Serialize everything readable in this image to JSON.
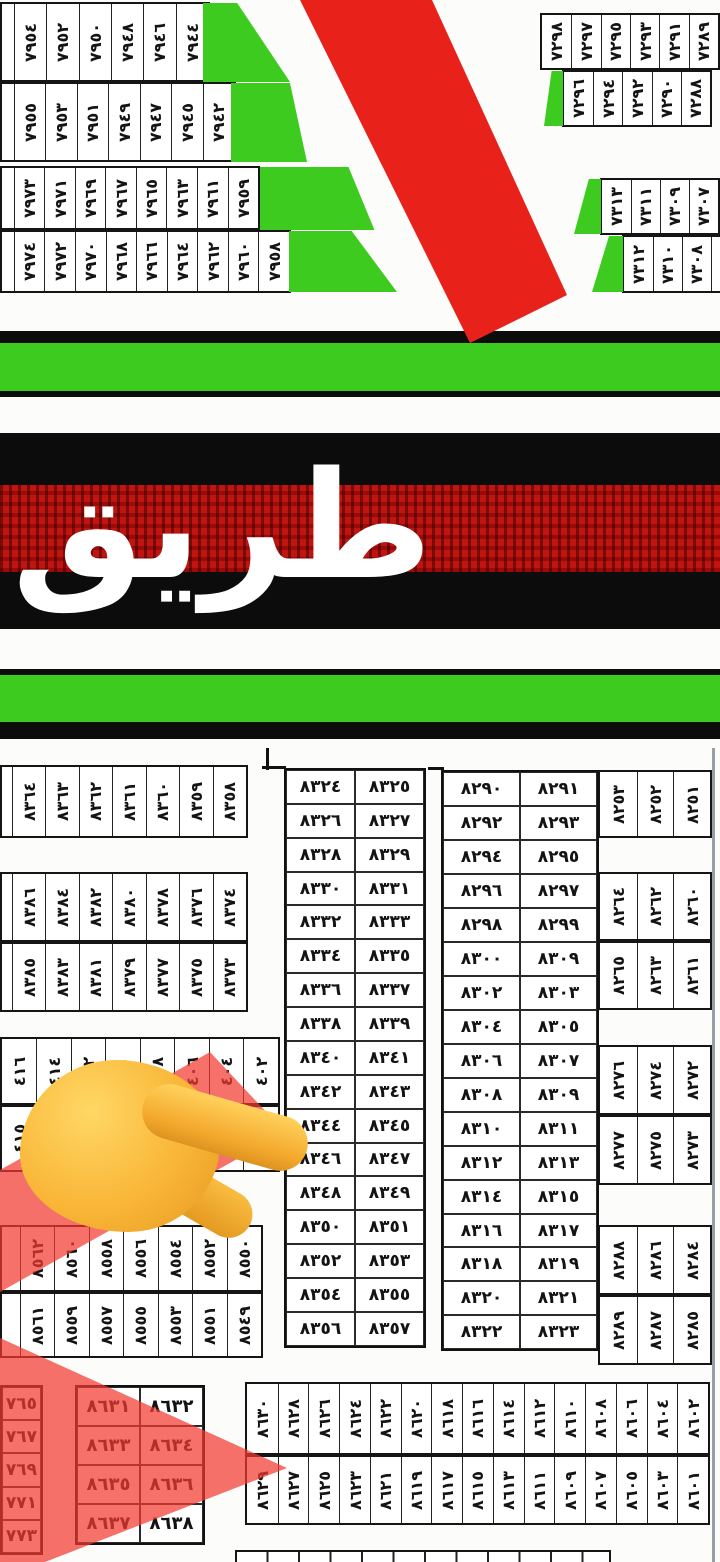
{
  "map": {
    "road_label": "طريق",
    "colors": {
      "block_green": "#3ecb20",
      "road_red_stripe": "#e8211b",
      "red_overlay": "#f33a30",
      "band_black": "#0c0c0c",
      "road_texture_red": "#c01410",
      "hand_yellow": "#f7b32b"
    },
    "top_left_block": {
      "row1": [
        "٧٩٥٤",
        "٧٩٥٢",
        "٧٩٥٠",
        "٧٩٤٨",
        "٧٩٤٦",
        "٧٩٤٤"
      ],
      "row2": [
        "٧٩٥٥",
        "٧٩٥٣",
        "٧٩٥١",
        "٧٩٤٩",
        "٧٩٤٧",
        "٧٩٤٥",
        "٧٩٤٢"
      ],
      "row3": [
        "٧٩٧٣",
        "٧٩٧١",
        "٧٩٦٩",
        "٧٩٦٧",
        "٧٩٦٥",
        "٧٩٦٣",
        "٧٩٦١",
        "٧٩٥٩"
      ],
      "row4": [
        "٧٩٧٤",
        "٧٩٧٢",
        "٧٩٧٠",
        "٧٩٦٨",
        "٧٩٦٦",
        "٧٩٦٤",
        "٧٩٦٢",
        "٧٩٦٠",
        "٧٩٥٨"
      ]
    },
    "top_right_blocks": {
      "b7290_row1": [
        "٧٢٩٨",
        "٧٢٩٧",
        "٧٢٩٥",
        "٧٢٩٣",
        "٧٢٩١",
        "٧٢٨٩"
      ],
      "b7290_row2": [
        "٧٢٩٦",
        "٧٢٩٤",
        "٧٢٩٢",
        "٧٢٩٠",
        "٧٢٨٨"
      ],
      "b7310_row1": [
        "٧٣١٣",
        "٧٣١١",
        "٧٣٠٩",
        "٧٣٠٧"
      ],
      "b7310_row2": [
        "٧٣١٢",
        "٧٣١٠",
        "٧٣٠٨",
        ""
      ]
    },
    "mid_left_strips": {
      "s8360": [
        "٨٣٦٤",
        "٨٣٦٣",
        "٨٣٦٢",
        "٨٣٦١",
        "٨٣٦٠",
        "٨٣٥٩",
        "٨٣٥٨"
      ],
      "s8380_top": [
        "٨٣٨٦",
        "٨٣٨٤",
        "٨٣٨٢",
        "٨٣٨٠",
        "٨٣٧٨",
        "٨٣٧٦",
        "٨٣٧٤"
      ],
      "s8380_bottom": [
        "٨٣٨٥",
        "٨٣٨٣",
        "٨٣٨١",
        "٨٣٧٩",
        "٨٣٧٧",
        "٨٣٧٥",
        "٨٣٧٣"
      ],
      "s400_top": [
        "٤١٦",
        "٤١٤",
        "٤١٢",
        "٤١٠",
        "٤٠٨",
        "٤٠٦",
        "٤٠٤",
        "٤٠٢"
      ],
      "s400_bottom": [
        "٤١٥",
        "٤١٣",
        "٤١١",
        "٤٠٩",
        "٤٠٧",
        "٤٠٥",
        "٤٠٣",
        "٤٠١"
      ],
      "s8550_top": [
        "٨٥٦٢",
        "٨٥٦٠",
        "٨٥٥٨",
        "٨٥٥٦",
        "٨٥٥٤",
        "٨٥٥٢",
        "٨٥٥٠"
      ],
      "s8550_bottom": [
        "٨٥٦١",
        "٨٥٥٩",
        "٨٥٥٧",
        "٨٥٥٥",
        "٨٥٥٣",
        "٨٥٥١",
        "٨٥٤٩"
      ]
    },
    "central_table": {
      "rows": [
        [
          "٨٣٢٤",
          "٨٣٢٥"
        ],
        [
          "٨٣٢٦",
          "٨٣٢٧"
        ],
        [
          "٨٣٢٨",
          "٨٣٢٩"
        ],
        [
          "٨٣٣٠",
          "٨٣٣١"
        ],
        [
          "٨٣٣٢",
          "٨٣٣٣"
        ],
        [
          "٨٣٣٤",
          "٨٣٣٥"
        ],
        [
          "٨٣٣٦",
          "٨٣٣٧"
        ],
        [
          "٨٣٣٨",
          "٨٣٣٩"
        ],
        [
          "٨٣٤٠",
          "٨٣٤١"
        ],
        [
          "٨٣٤٢",
          "٨٣٤٣"
        ],
        [
          "٨٣٤٤",
          "٨٣٤٥"
        ],
        [
          "٨٣٤٦",
          "٨٣٤٧"
        ],
        [
          "٨٣٤٨",
          "٨٣٤٩"
        ],
        [
          "٨٣٥٠",
          "٨٣٥١"
        ],
        [
          "٨٣٥٢",
          "٨٣٥٣"
        ],
        [
          "٨٣٥٤",
          "٨٣٥٥"
        ],
        [
          "٨٣٥٦",
          "٨٣٥٧"
        ]
      ]
    },
    "right_table": {
      "rows": [
        [
          "٨٢٩٠",
          "٨٢٩١"
        ],
        [
          "٨٢٩٢",
          "٨٢٩٣"
        ],
        [
          "٨٢٩٤",
          "٨٢٩٥"
        ],
        [
          "٨٢٩٦",
          "٨٢٩٧"
        ],
        [
          "٨٢٩٨",
          "٨٢٩٩"
        ],
        [
          "٨٣٠٠",
          "٨٣٠٩"
        ],
        [
          "٨٣٠٢",
          "٨٣٠٣"
        ],
        [
          "٨٣٠٤",
          "٨٣٠٥"
        ],
        [
          "٨٣٠٦",
          "٨٣٠٧"
        ],
        [
          "٨٣٠٨",
          "٨٣٠٩"
        ],
        [
          "٨٣١٠",
          "٨٣١١"
        ],
        [
          "٨٣١٢",
          "٨٣١٣"
        ],
        [
          "٨٣١٤",
          "٨٣١٥"
        ],
        [
          "٨٣١٦",
          "٨٣١٧"
        ],
        [
          "٨٣١٨",
          "٨٣١٩"
        ],
        [
          "٨٣٢٠",
          "٨٣٢١"
        ],
        [
          "٨٣٢٢",
          "٨٣٢٣"
        ]
      ]
    },
    "right_blocks": {
      "b8250": [
        "٨٢٥٣",
        "٨٢٥٢",
        "٨٢٥١"
      ],
      "b8260_top": [
        "٨٢٦٤",
        "٨٢٦٢",
        "٨٢٦٠"
      ],
      "b8260_bottom": [
        "٨٢٦٥",
        "٨٢٦٣",
        "٨٢٦١"
      ],
      "b8270_top": [
        "٨٢٧٦",
        "٨٢٧٤",
        "٨٢٧٢"
      ],
      "b8270_bottom": [
        "٨٢٧٧",
        "٨٢٧٥",
        "٨٢٧٣"
      ],
      "b8280_top": [
        "٨٢٨٨",
        "٨٢٨٦",
        "٨٢٨٤"
      ],
      "b8280_bottom": [
        "٨٢٨٩",
        "٨٢٨٧",
        "٨٢٨٥"
      ]
    },
    "bottom": {
      "left_col": [
        "٧٦٥",
        "٧٦٧",
        "٧٦٩",
        "٧٧١",
        "٧٧٣"
      ],
      "small_table_rows": [
        [
          "٨٦٣١",
          "٨٦٣٢"
        ],
        [
          "٨٦٣٣",
          "٨٦٣٤"
        ],
        [
          "٨٦٣٥",
          "٨٦٣٦"
        ],
        [
          "٨٦٣٧",
          "٨٦٣٨"
        ]
      ],
      "wide_table_top": [
        "٨٦٣٠",
        "٨٦٢٨",
        "٨٦٢٦",
        "٨٦٢٤",
        "٨٦٢٢",
        "٨٦٢٠",
        "٨٦١٨",
        "٨٦١٦",
        "٨٦١٤",
        "٨٦١٢",
        "٨٦١٠",
        "٨٦٠٨",
        "٨٦٠٦",
        "٨٦٠٤",
        "٨٦٠٢"
      ],
      "wide_table_bottom": [
        "٨٦٢٩",
        "٨٦٢٧",
        "٨٦٢٥",
        "٨٦٢٣",
        "٨٦٢١",
        "٨٦١٩",
        "٨٦١٧",
        "٨٦١٥",
        "٨٦١٣",
        "٨٦١١",
        "٨٦٠٩",
        "٨٦٠٧",
        "٨٦٠٥",
        "٨٦٠٣",
        "٨٦٠١"
      ]
    }
  }
}
